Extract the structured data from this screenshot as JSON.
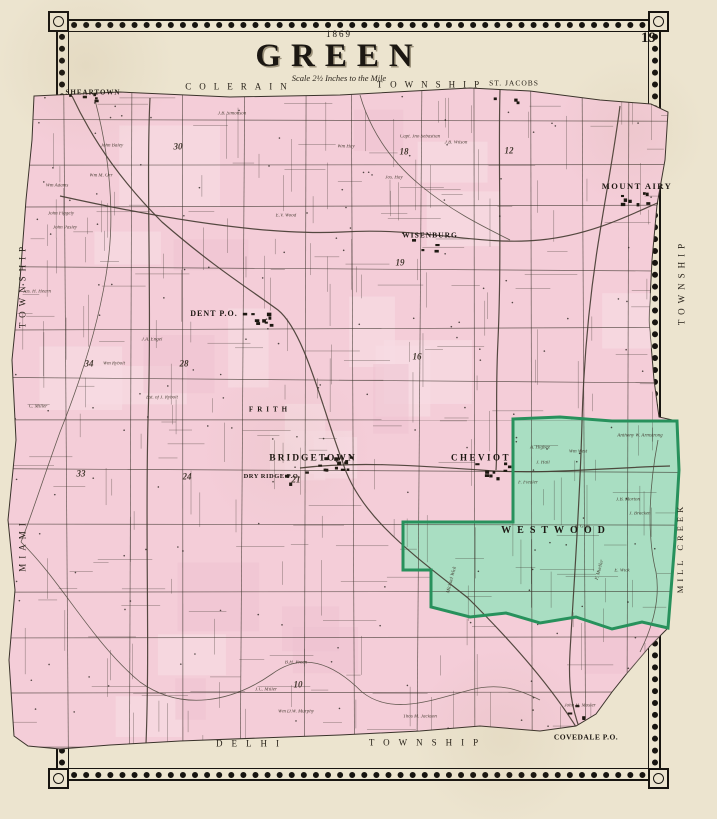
{
  "title_block": {
    "year": "1869",
    "title": "GREEN",
    "scale": "Scale 2½ Inches to the Mile"
  },
  "page_number": "19",
  "colors": {
    "paper": "#ece4cf",
    "map_pink": "#f4cdd8",
    "map_pink_light": "#f8dce3",
    "map_pink_dark": "#eec2cf",
    "highlight_green": "#a9dec2",
    "highlight_border": "#27915c",
    "ink": "#3a332b",
    "frame": "#171410"
  },
  "border_labels": [
    {
      "text": "COLERAIN",
      "x": 240,
      "y": 87,
      "size": 9,
      "ls": 8
    },
    {
      "text": "TOWNSHIP",
      "x": 432,
      "y": 85,
      "size": 9,
      "ls": 8
    },
    {
      "text": "ST. JACOBS",
      "x": 514,
      "y": 83,
      "size": 7.5,
      "ls": 1
    },
    {
      "text": "TOWNSHIP",
      "x": 23,
      "y": 285,
      "size": 9,
      "ls": 5,
      "rot": -90
    },
    {
      "text": "MIAMI",
      "x": 23,
      "y": 545,
      "size": 9,
      "ls": 5,
      "rot": -90
    },
    {
      "text": "TOWNSHIP",
      "x": 682,
      "y": 282,
      "size": 9,
      "ls": 5,
      "rot": -90
    },
    {
      "text": "MILL CREEK",
      "x": 680,
      "y": 548,
      "size": 8.5,
      "ls": 4,
      "rot": -90
    },
    {
      "text": "DELHI",
      "x": 252,
      "y": 744,
      "size": 9,
      "ls": 9
    },
    {
      "text": "TOWNSHIP",
      "x": 428,
      "y": 743,
      "size": 9,
      "ls": 9
    }
  ],
  "places": [
    {
      "name": "SHEARTOWN",
      "x": 93,
      "y": 93,
      "size": 7,
      "ls": 1
    },
    {
      "name": "MOUNT AIRY",
      "x": 637,
      "y": 186,
      "size": 8.5,
      "ls": 1.5
    },
    {
      "name": "WISENBURG",
      "x": 430,
      "y": 235,
      "size": 7.5,
      "ls": 1
    },
    {
      "name": "DENT P.O.",
      "x": 214,
      "y": 314,
      "size": 8,
      "ls": 1
    },
    {
      "name": "FRITH",
      "x": 270,
      "y": 410,
      "size": 7,
      "ls": 4
    },
    {
      "name": "BRIDGETOWN",
      "x": 313,
      "y": 459,
      "size": 9.5,
      "ls": 2
    },
    {
      "name": "DRY RIDGE P.O.",
      "x": 272,
      "y": 477,
      "size": 6.5,
      "ls": 0.5
    },
    {
      "name": "CHEVIOT",
      "x": 481,
      "y": 458,
      "size": 9,
      "ls": 2.5
    },
    {
      "name": "WESTWOOD",
      "x": 556,
      "y": 531,
      "size": 10,
      "ls": 6
    },
    {
      "name": "COVEDALE P.O.",
      "x": 586,
      "y": 737,
      "size": 7.5,
      "ls": 0.5
    }
  ],
  "section_numbers": [
    {
      "n": "30",
      "x": 178,
      "y": 147
    },
    {
      "n": "18",
      "x": 404,
      "y": 152
    },
    {
      "n": "12",
      "x": 509,
      "y": 151
    },
    {
      "n": "19",
      "x": 400,
      "y": 263
    },
    {
      "n": "16",
      "x": 417,
      "y": 357
    },
    {
      "n": "21",
      "x": 296,
      "y": 480
    },
    {
      "n": "34",
      "x": 89,
      "y": 364
    },
    {
      "n": "28",
      "x": 184,
      "y": 364
    },
    {
      "n": "33",
      "x": 81,
      "y": 474
    },
    {
      "n": "24",
      "x": 187,
      "y": 477
    },
    {
      "n": "10",
      "x": 298,
      "y": 685
    }
  ],
  "parcel_names": [
    {
      "name": "J.B. Simonson",
      "x": 232,
      "y": 114
    },
    {
      "name": "John Baley",
      "x": 112,
      "y": 146
    },
    {
      "name": "Wm M. Orr",
      "x": 101,
      "y": 176
    },
    {
      "name": "Wm Adams",
      "x": 57,
      "y": 186
    },
    {
      "name": "John Flagely",
      "x": 61,
      "y": 214
    },
    {
      "name": "John Pasley",
      "x": 65,
      "y": 228
    },
    {
      "name": "E.V. Wood",
      "x": 286,
      "y": 216
    },
    {
      "name": "Jos. Hay",
      "x": 394,
      "y": 178
    },
    {
      "name": "Capt. Jno Sebastian",
      "x": 420,
      "y": 137
    },
    {
      "name": "J.B. Wilson",
      "x": 456,
      "y": 143
    },
    {
      "name": "Wm Hay",
      "x": 346,
      "y": 147
    },
    {
      "name": "Wm Rybolt",
      "x": 114,
      "y": 364,
      "rot": 0
    },
    {
      "name": "Est. of J. Rybolt",
      "x": 162,
      "y": 398
    },
    {
      "name": "J.A. Engel",
      "x": 152,
      "y": 340
    },
    {
      "name": "Jas. H. Hearn",
      "x": 37,
      "y": 292
    },
    {
      "name": "C. Miller",
      "x": 38,
      "y": 407
    },
    {
      "name": "B.H. Preen",
      "x": 296,
      "y": 663
    },
    {
      "name": "J.C. Miller",
      "x": 266,
      "y": 690
    },
    {
      "name": "Wm D.W. Murphy",
      "x": 296,
      "y": 712
    },
    {
      "name": "Thos M. Jackson",
      "x": 420,
      "y": 717
    },
    {
      "name": "John H. Mosier",
      "x": 580,
      "y": 706
    },
    {
      "name": "Anthony W. Armstrong",
      "x": 640,
      "y": 436
    },
    {
      "name": "J.B. Morton",
      "x": 628,
      "y": 500
    },
    {
      "name": "J. Bracken",
      "x": 640,
      "y": 514
    },
    {
      "name": "F. Fiedler",
      "x": 528,
      "y": 483
    },
    {
      "name": "A. Higbee",
      "x": 540,
      "y": 448
    },
    {
      "name": "J. Hall",
      "x": 543,
      "y": 463
    },
    {
      "name": "Wm West",
      "x": 578,
      "y": 452
    },
    {
      "name": "A. Graf",
      "x": 582,
      "y": 527
    },
    {
      "name": "Michael Wick",
      "x": 452,
      "y": 580,
      "rot": -75
    },
    {
      "name": "F. Mueller",
      "x": 600,
      "y": 570,
      "rot": -75
    },
    {
      "name": "E. Wick",
      "x": 622,
      "y": 571
    }
  ]
}
